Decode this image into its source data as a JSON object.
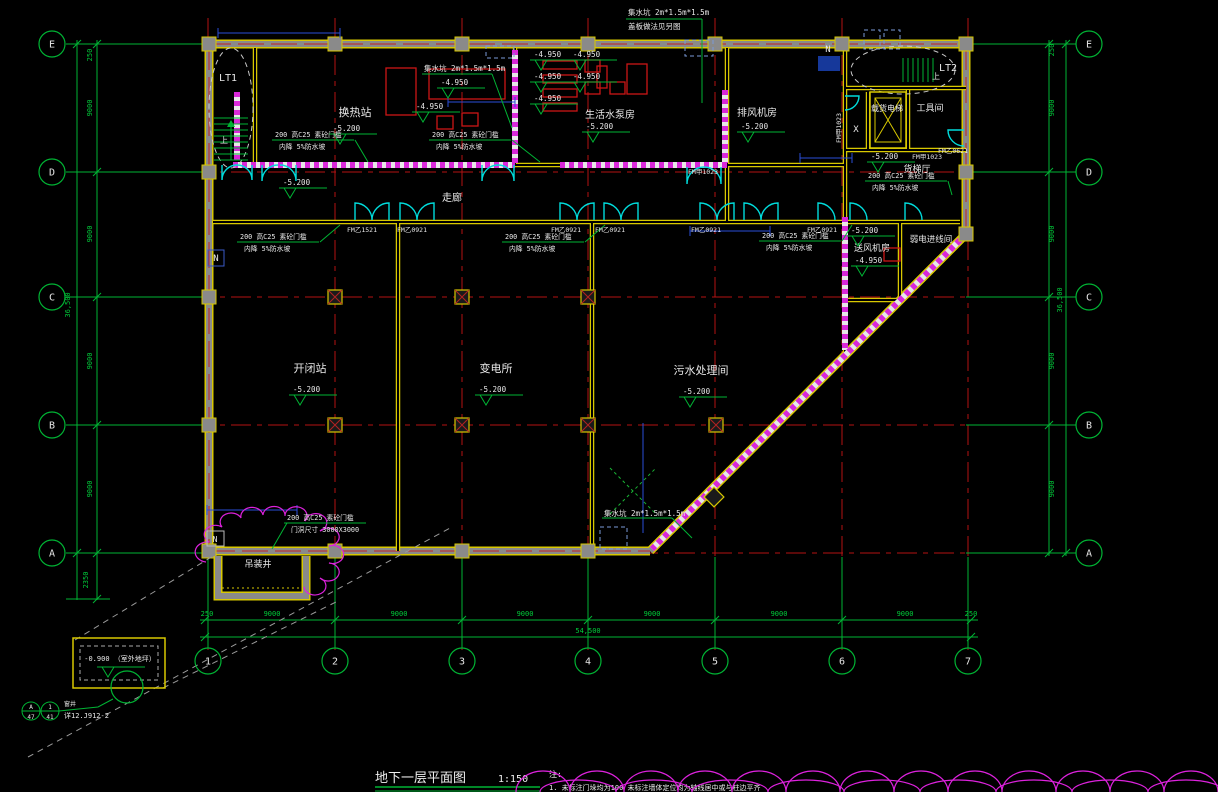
{
  "title": {
    "text": "地下一层平面图",
    "scale": "1:150"
  },
  "notes": {
    "label": "注:",
    "line1": "1. 未标注门垛均为100  未标注墙体定位均为轴线居中或与柱边平齐"
  },
  "colors": {
    "background": "#000000",
    "grid": "#b31212",
    "dims": "#00b434",
    "walls": "#d8c800",
    "doors": "#00dcdc",
    "hatch": "#d828d8",
    "equipment": "#cc1515",
    "text": "#e8e8e8"
  },
  "grid_bubbles": [
    {
      "x": 52,
      "y": 44,
      "t": "E"
    },
    {
      "x": 52,
      "y": 172,
      "t": "D"
    },
    {
      "x": 52,
      "y": 297,
      "t": "C"
    },
    {
      "x": 52,
      "y": 425,
      "t": "B"
    },
    {
      "x": 52,
      "y": 553,
      "t": "A"
    },
    {
      "x": 1089,
      "y": 44,
      "t": "E"
    },
    {
      "x": 1089,
      "y": 172,
      "t": "D"
    },
    {
      "x": 1089,
      "y": 297,
      "t": "C"
    },
    {
      "x": 1089,
      "y": 425,
      "t": "B"
    },
    {
      "x": 1089,
      "y": 553,
      "t": "A"
    },
    {
      "x": 208,
      "y": 661,
      "t": "1"
    },
    {
      "x": 335,
      "y": 661,
      "t": "2"
    },
    {
      "x": 462,
      "y": 661,
      "t": "3"
    },
    {
      "x": 588,
      "y": 661,
      "t": "4"
    },
    {
      "x": 715,
      "y": 661,
      "t": "5"
    },
    {
      "x": 842,
      "y": 661,
      "t": "6"
    },
    {
      "x": 968,
      "y": 661,
      "t": "7"
    }
  ],
  "dim_labels": [
    {
      "x": 207,
      "y": 616,
      "t": "250"
    },
    {
      "x": 272,
      "y": 616,
      "t": "9000"
    },
    {
      "x": 399,
      "y": 616,
      "t": "9000"
    },
    {
      "x": 525,
      "y": 616,
      "t": "9000"
    },
    {
      "x": 652,
      "y": 616,
      "t": "9000"
    },
    {
      "x": 779,
      "y": 616,
      "t": "9000"
    },
    {
      "x": 905,
      "y": 616,
      "t": "9000"
    },
    {
      "x": 971,
      "y": 616,
      "t": "250"
    },
    {
      "x": 588,
      "y": 633,
      "t": "54,500"
    },
    {
      "x": 92,
      "y": 55,
      "t": "250",
      "r": -90
    },
    {
      "x": 92,
      "y": 108,
      "t": "9000",
      "r": -90
    },
    {
      "x": 92,
      "y": 234,
      "t": "9000",
      "r": -90
    },
    {
      "x": 92,
      "y": 361,
      "t": "9000",
      "r": -90
    },
    {
      "x": 92,
      "y": 489,
      "t": "9000",
      "r": -90
    },
    {
      "x": 88,
      "y": 580,
      "t": "2350",
      "r": -90
    },
    {
      "x": 70,
      "y": 305,
      "t": "36,500",
      "r": -90
    },
    {
      "x": 1054,
      "y": 50,
      "t": "250",
      "r": -90
    },
    {
      "x": 1054,
      "y": 108,
      "t": "9000",
      "r": -90
    },
    {
      "x": 1054,
      "y": 234,
      "t": "9000",
      "r": -90
    },
    {
      "x": 1054,
      "y": 361,
      "t": "9000",
      "r": -90
    },
    {
      "x": 1054,
      "y": 489,
      "t": "9000",
      "r": -90
    },
    {
      "x": 1062,
      "y": 300,
      "t": "36,500",
      "r": -90
    }
  ],
  "labels": [
    {
      "x": 228,
      "y": 81,
      "t": "LT1",
      "s": 10
    },
    {
      "x": 948,
      "y": 71,
      "t": "LT2",
      "s": 10
    },
    {
      "x": 224,
      "y": 143,
      "t": "上",
      "s": 8
    },
    {
      "x": 936,
      "y": 79,
      "t": "上",
      "s": 8
    },
    {
      "x": 355,
      "y": 116,
      "t": "换热站",
      "s": 11
    },
    {
      "x": 610,
      "y": 118,
      "t": "生活水泵房",
      "s": 10
    },
    {
      "x": 757,
      "y": 116,
      "t": "排风机房",
      "s": 10
    },
    {
      "x": 887,
      "y": 111,
      "t": "载货电梯",
      "s": 8
    },
    {
      "x": 930,
      "y": 111,
      "t": "工具间",
      "s": 9
    },
    {
      "x": 856,
      "y": 132,
      "t": "X",
      "s": 9
    },
    {
      "x": 917,
      "y": 172,
      "t": "货梯厅",
      "s": 9
    },
    {
      "x": 872,
      "y": 251,
      "t": "送风机房",
      "s": 9
    },
    {
      "x": 931,
      "y": 242,
      "t": "弱电进线间",
      "s": 8.5
    },
    {
      "x": 452,
      "y": 201,
      "t": "走廊",
      "s": 10
    },
    {
      "x": 310,
      "y": 372,
      "t": "开闭站",
      "s": 11
    },
    {
      "x": 496,
      "y": 372,
      "t": "变电所",
      "s": 11
    },
    {
      "x": 701,
      "y": 374,
      "t": "污水处理间",
      "s": 11
    },
    {
      "x": 258,
      "y": 567,
      "t": "吊装井",
      "s": 9
    },
    {
      "x": 828,
      "y": 52,
      "t": "N",
      "s": 9
    },
    {
      "x": 216,
      "y": 261,
      "t": "N",
      "s": 9
    },
    {
      "x": 215,
      "y": 542,
      "t": "N",
      "s": 8
    },
    {
      "x": 688,
      "y": 174,
      "t": "FM甲1023",
      "s": 6.5,
      "a": "s"
    },
    {
      "x": 841,
      "y": 128,
      "t": "FM甲1023",
      "s": 6.5,
      "r": -90
    },
    {
      "x": 912,
      "y": 159,
      "t": "FM甲1023",
      "s": 6.5,
      "a": "s"
    },
    {
      "x": 938,
      "y": 153,
      "t": "FM乙0621",
      "s": 6.5,
      "a": "s"
    },
    {
      "x": 362,
      "y": 232,
      "t": "FM乙1521",
      "s": 6.5
    },
    {
      "x": 412,
      "y": 232,
      "t": "FM乙0921",
      "s": 6.5
    },
    {
      "x": 566,
      "y": 232,
      "t": "FM乙0921",
      "s": 6.5
    },
    {
      "x": 610,
      "y": 232,
      "t": "FM乙0921",
      "s": 6.5
    },
    {
      "x": 706,
      "y": 232,
      "t": "FM乙0921",
      "s": 6.5
    },
    {
      "x": 822,
      "y": 232,
      "t": "FM乙0921",
      "s": 6.5
    },
    {
      "x": 628,
      "y": 15,
      "t": "集水坑 2m*1.5m*1.5m",
      "s": 7.5,
      "a": "s"
    },
    {
      "x": 628,
      "y": 29,
      "t": "盖板做法见另图",
      "s": 7.5,
      "a": "s"
    },
    {
      "x": 424,
      "y": 71,
      "t": "集水坑 2m*1.5m*1.5m",
      "s": 7.5,
      "a": "s"
    },
    {
      "x": 604,
      "y": 516,
      "t": "集水坑 2m*1.5m*1.5m",
      "s": 7.5,
      "a": "s"
    },
    {
      "x": 120,
      "y": 661,
      "t": "-0.900 （室外地坪）",
      "s": 7
    },
    {
      "x": 64,
      "y": 706,
      "t": "窗井",
      "s": 6,
      "a": "s"
    },
    {
      "x": 64,
      "y": 718,
      "t": "详12.J912-2",
      "s": 7,
      "a": "s"
    }
  ],
  "spots": [
    {
      "x": 332,
      "y": 131,
      "t": "-5.200"
    },
    {
      "x": 585,
      "y": 129,
      "t": "-5.200"
    },
    {
      "x": 740,
      "y": 129,
      "t": "-5.200"
    },
    {
      "x": 870,
      "y": 159,
      "t": "-5.200"
    },
    {
      "x": 850,
      "y": 233,
      "t": "-5.200"
    },
    {
      "x": 282,
      "y": 185,
      "t": "-5.200"
    },
    {
      "x": 292,
      "y": 392,
      "t": "-5.200"
    },
    {
      "x": 478,
      "y": 392,
      "t": "-5.200"
    },
    {
      "x": 682,
      "y": 394,
      "t": "-5.200"
    },
    {
      "x": 415,
      "y": 109,
      "t": "-4.950"
    },
    {
      "x": 440,
      "y": 85,
      "t": "-4.950"
    },
    {
      "x": 533,
      "y": 57,
      "t": "-4.950"
    },
    {
      "x": 572,
      "y": 57,
      "t": "-4.950"
    },
    {
      "x": 533,
      "y": 79,
      "t": "-4.950"
    },
    {
      "x": 572,
      "y": 79,
      "t": "-4.950"
    },
    {
      "x": 533,
      "y": 101,
      "t": "-4.950"
    },
    {
      "x": 854,
      "y": 263,
      "t": "-4.950"
    },
    {
      "x": 100,
      "y": 664,
      "t": ""
    }
  ],
  "sill_notes": [
    {
      "x": 275,
      "y": 137,
      "l1": "200 高C25 素砼门槛",
      "l2": "内降 5%防水坡"
    },
    {
      "x": 432,
      "y": 137,
      "l1": "200 高C25 素砼门槛",
      "l2": "内降 5%防水坡"
    },
    {
      "x": 240,
      "y": 239,
      "l1": "200 高C25 素砼门槛",
      "l2": "内降 5%防水坡"
    },
    {
      "x": 505,
      "y": 239,
      "l1": "200 高C25 素砼门槛",
      "l2": "内降 5%防水坡"
    },
    {
      "x": 762,
      "y": 238,
      "l1": "200 高C25 素砼门槛",
      "l2": "内降 5%防水坡"
    },
    {
      "x": 868,
      "y": 178,
      "l1": "200 高C25 素砼门槛",
      "l2": "内降 5%防水坡"
    },
    {
      "x": 287,
      "y": 520,
      "l1": "200 高C25 素砼门槛",
      "l2": "门洞尺寸 3000X3000"
    }
  ],
  "detail_bubbles": [
    {
      "x": 31,
      "y": 711,
      "top": "A",
      "bot": "47"
    },
    {
      "x": 50,
      "y": 711,
      "top": "1",
      "bot": "41"
    }
  ]
}
